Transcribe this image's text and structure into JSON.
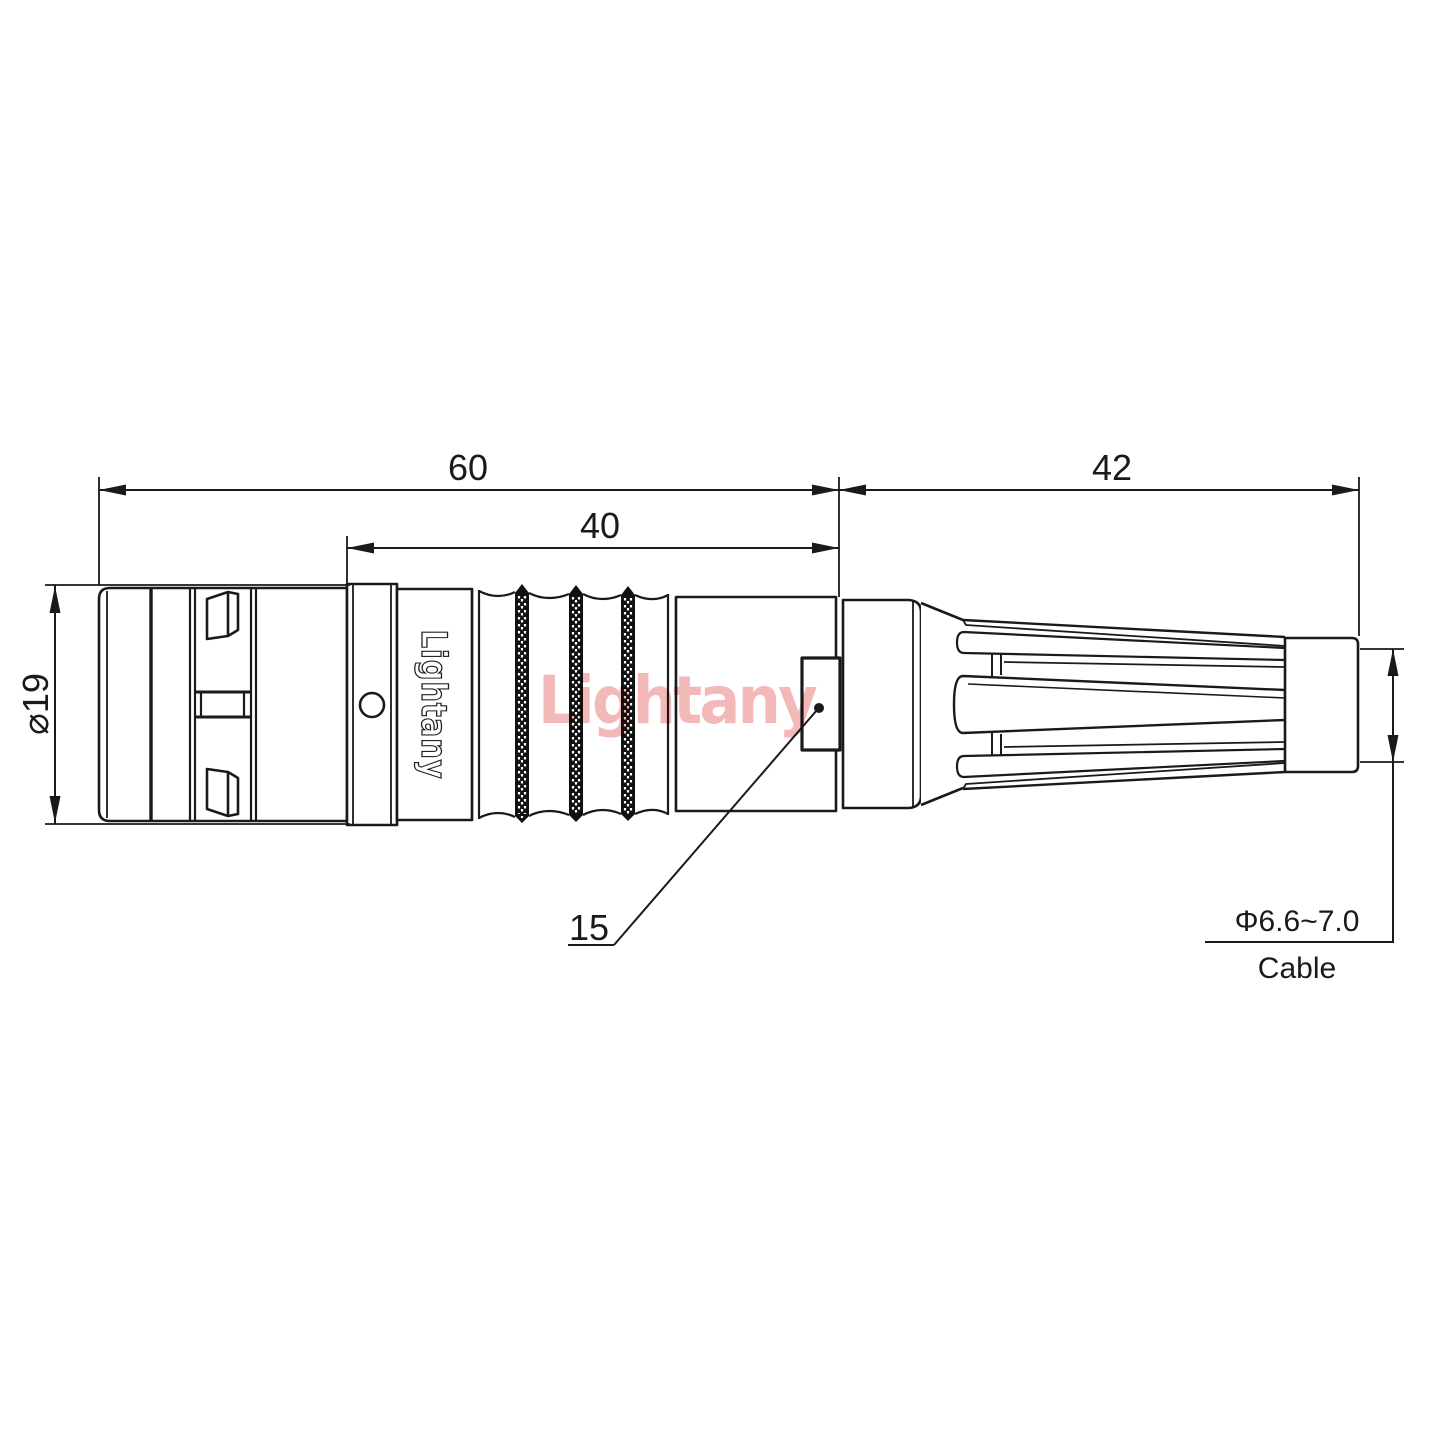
{
  "drawing": {
    "brand_text": "Lightany",
    "watermark_text": "Lightany",
    "dims": {
      "total_length": "60",
      "rear_length": "40",
      "boot_length": "42",
      "front_diameter": "⌀19",
      "slot_ref": "15",
      "cable_diameter": "Φ6.6~7.0",
      "cable_word": "Cable"
    },
    "colors": {
      "ink": "#1a1a1a",
      "watermark": "#f0a8a8",
      "paper": "#ffffff"
    }
  }
}
